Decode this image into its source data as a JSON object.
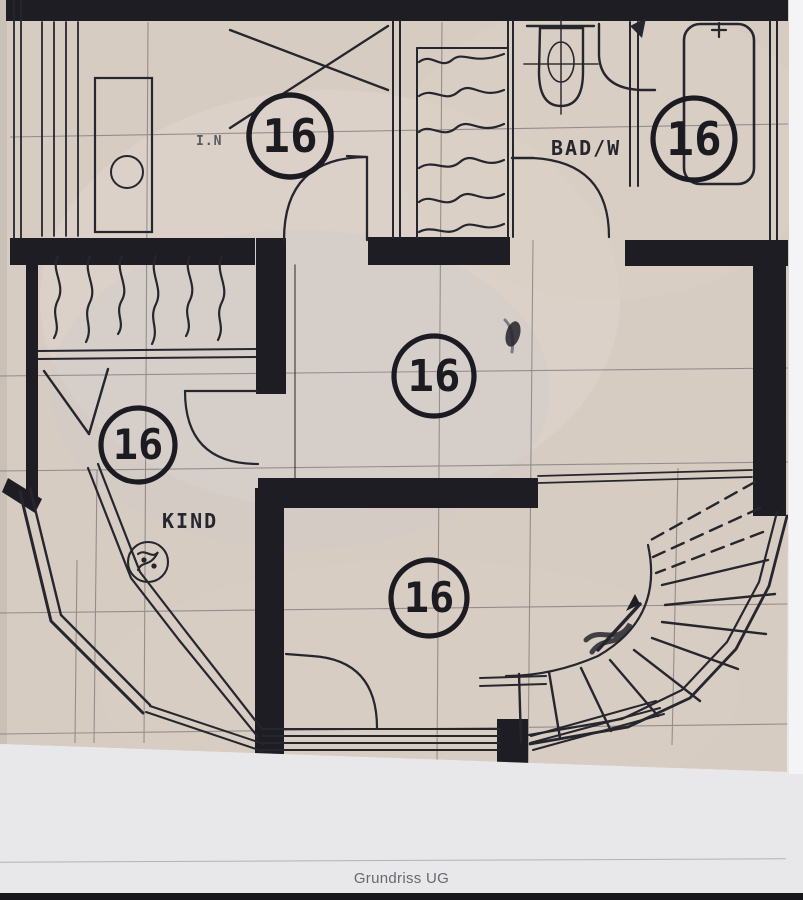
{
  "floorplan": {
    "badges": [
      {
        "room": "top-left-room",
        "number": "16"
      },
      {
        "room": "bathroom",
        "number": "16"
      },
      {
        "room": "center-hall",
        "number": "16"
      },
      {
        "room": "child-room",
        "number": "16"
      },
      {
        "room": "bottom-room",
        "number": "16"
      }
    ],
    "labels": {
      "bathroom": "BAD/W",
      "child_room": "KIND",
      "top_left": "I.N"
    }
  },
  "caption": {
    "text": "Grundriss UG"
  },
  "colors": {
    "paper": "#d7ccc2",
    "ink": "#1d1d23",
    "photo_background": "#e8e8eb",
    "bottom_bar": "#15151a",
    "caption_text": "#68686e"
  }
}
